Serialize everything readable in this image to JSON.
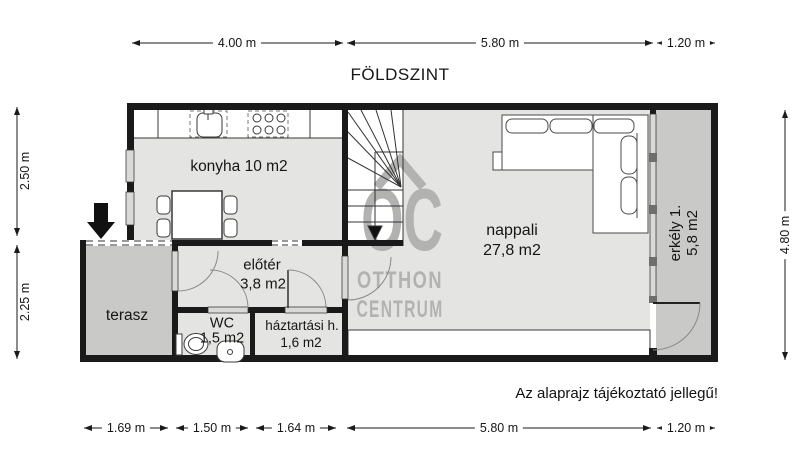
{
  "title": "FÖLDSZINT",
  "note": "Az alaprajz tájékoztató jellegű!",
  "watermark": {
    "logo": "OC",
    "line1": "OTTHON",
    "line2": "CENTRUM"
  },
  "rooms": {
    "konyha": {
      "label": "konyha 10 m2"
    },
    "nappali": {
      "name": "nappali",
      "area": "27,8 m2"
    },
    "erkely": {
      "name": "erkély 1.",
      "area": "5,8 m2"
    },
    "eloter": {
      "name": "előtér",
      "area": "3,8 m2"
    },
    "wc": {
      "name": "WC",
      "area": "1,5 m2"
    },
    "haztartasi": {
      "name": "háztartási h.",
      "area": "1,6 m2"
    },
    "terasz": {
      "name": "terasz"
    }
  },
  "dimensions": {
    "top": [
      "4.00 m",
      "5.80 m",
      "1.20 m"
    ],
    "bottom": [
      "1.69 m",
      "1.50 m",
      "1.64 m",
      "5.80 m",
      "1.20 m"
    ],
    "left": [
      "2.50 m",
      "2.25 m"
    ],
    "right": [
      "4.80 m"
    ]
  },
  "colors": {
    "wall": "#1a1a1a",
    "floor_indoor": "#e4e4e2",
    "floor_outdoor": "#c9c9c7",
    "window": "#d9d9d7",
    "watermark": "#b2b2b0",
    "background": "#ffffff"
  }
}
